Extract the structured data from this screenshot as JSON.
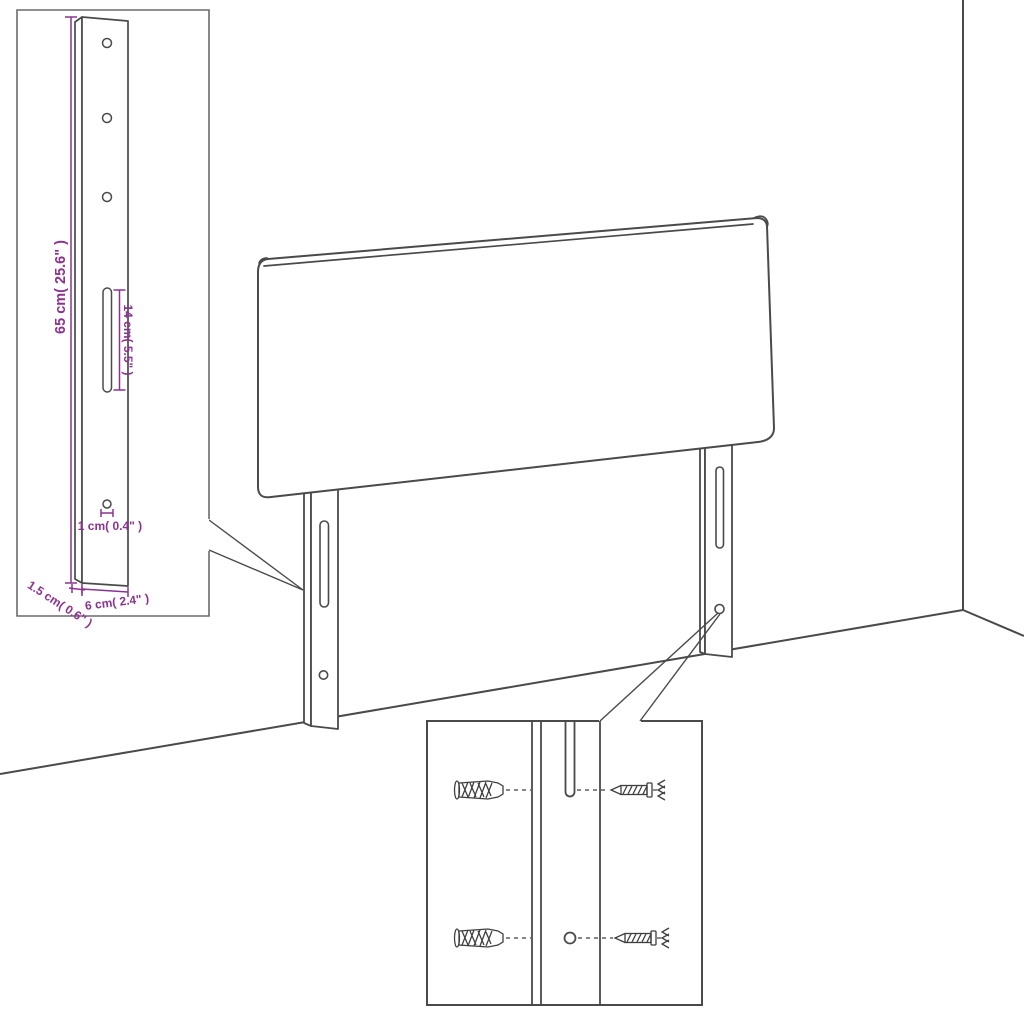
{
  "diagram": {
    "description": "Headboard wall-mounting assembly line drawing",
    "colors": {
      "outline": "#4a4a4a",
      "dimension": "#8b3390",
      "background": "#ffffff"
    },
    "leg_detail_inset": {
      "labels": {
        "leg_height": "65 cm( 25.6\" )",
        "slot_length": "14 cm( 5.5\" )",
        "hole_diameter": "1 cm( 0.4\" )",
        "leg_thickness": "1.5 cm( 0.6\" )",
        "leg_width": "6 cm( 2.4\" )"
      }
    }
  }
}
